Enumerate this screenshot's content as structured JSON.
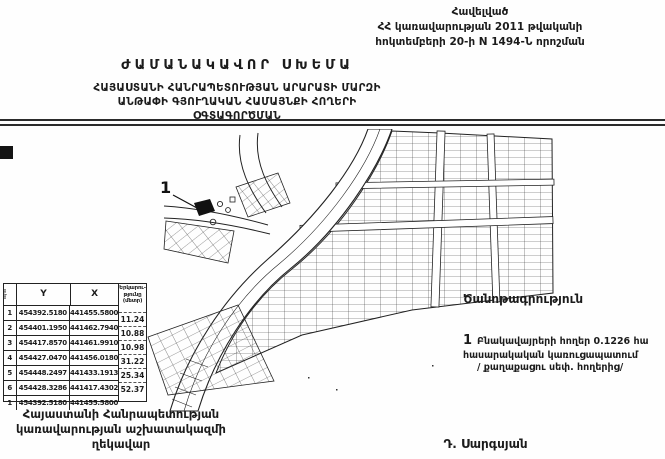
{
  "page": {
    "background": "#fefefe",
    "ink": "#1b1b1b"
  },
  "header": {
    "annex_lines": [
      "Հավելված",
      "ՀՀ կառավարության 2011 թվականի",
      "հոկտեմբերի 20-ի N 1494-Ն որոշման"
    ],
    "title": "ԺԱՄԱՆԱԿԱՎՈՐ ՍԽԵՄԱ",
    "subtitle_lines": [
      "ՀԱՅԱՍՏԱՆԻ ՀԱՆՐԱՊԵՏՈՒԹՅԱՆ ԱՐԱՐԱՏԻ ՄԱՐԶԻ",
      "ԱՆԹԱՓԻ ԳՅՈՒՂԱԿԱՆ ՀԱՄԱՅՆՔԻ ՀՈՂԵՐԻ",
      "ՕԳՏԱԳՈՐԾՄԱՆ"
    ]
  },
  "map": {
    "marker_label": "1"
  },
  "coords_table": {
    "index_header": "հ/հ",
    "y_header": "Y",
    "x_header": "X",
    "length_header_lines": [
      "Երկարու-",
      "թյունը",
      "(մետր)"
    ],
    "rows": [
      {
        "n": "1",
        "y": "454392.5180",
        "x": "441455.5800"
      },
      {
        "n": "2",
        "y": "454401.1950",
        "x": "441462.7940"
      },
      {
        "n": "3",
        "y": "454417.8570",
        "x": "441461.9910"
      },
      {
        "n": "4",
        "y": "454427.0470",
        "x": "441456.0180"
      },
      {
        "n": "5",
        "y": "454448.2497",
        "x": "441433.1913"
      },
      {
        "n": "6",
        "y": "454428.3286",
        "x": "441417.4302"
      },
      {
        "n": "1",
        "y": "454392.5180",
        "x": "441455.5800"
      }
    ],
    "lengths": [
      "11.24",
      "10.88",
      "10.98",
      "31.22",
      "25.34",
      "52.37"
    ]
  },
  "note": {
    "heading": "Ծանոթագրություն",
    "symbol": "1",
    "lines": [
      "Բնակավայրերի հողեր 0.1226 հա",
      "հասարակական կառուցապատում",
      "/ քաղաքացու սեփ. հողերից/"
    ]
  },
  "signature": {
    "left_lines": [
      "Հայաստանի Հանրապետության",
      "կառավարության աշխատակազմի",
      "ղեկավար"
    ],
    "right_name": "Դ. Սարգսյան"
  }
}
